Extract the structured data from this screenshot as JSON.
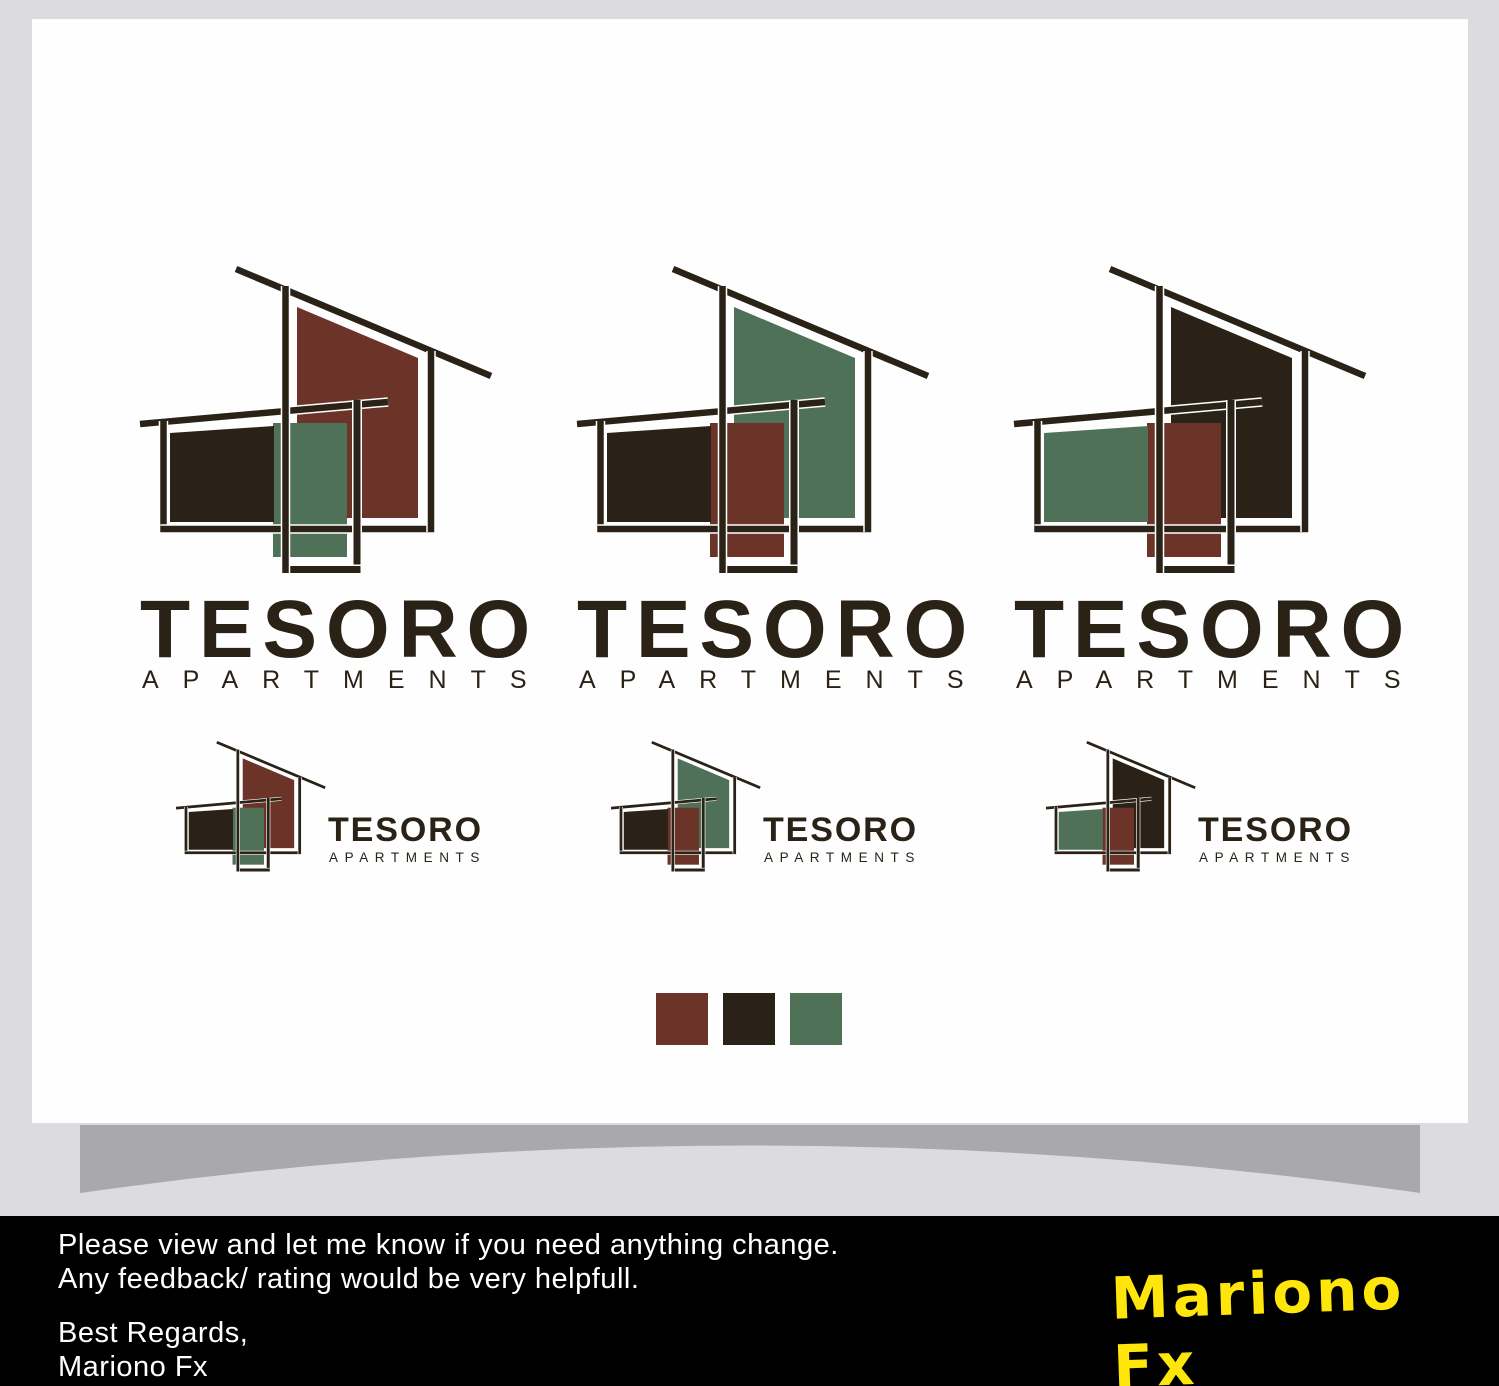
{
  "brand": {
    "name": "TESORO",
    "tagline": "APARTMENTS"
  },
  "palette": {
    "maroon": "#6C3328",
    "dark": "#2A2217",
    "green": "#4F7158",
    "outline": "#2A2217",
    "halo": "#FFFFFF"
  },
  "logo_variants": [
    {
      "big": "maroon",
      "left": "dark",
      "door": "green"
    },
    {
      "big": "green",
      "left": "dark",
      "door": "maroon"
    },
    {
      "big": "dark",
      "left": "green",
      "door": "maroon"
    }
  ],
  "swatches": [
    "maroon",
    "dark",
    "green"
  ],
  "canvas": {
    "background": "#FEFEFE",
    "page_background": "#DCDCDE",
    "shadow_color": "#A9A9AB"
  },
  "footer": {
    "background": "#000000",
    "text_color": "#FFFFFF",
    "line1": "Please view and let me know if you need anything change.",
    "line2": "Any feedback/ rating would be very helpfull.",
    "closing1": "Best Regards,",
    "closing2": "Mariono Fx",
    "signature": "Mariono Fx",
    "signature_color": "#FFE60A"
  }
}
